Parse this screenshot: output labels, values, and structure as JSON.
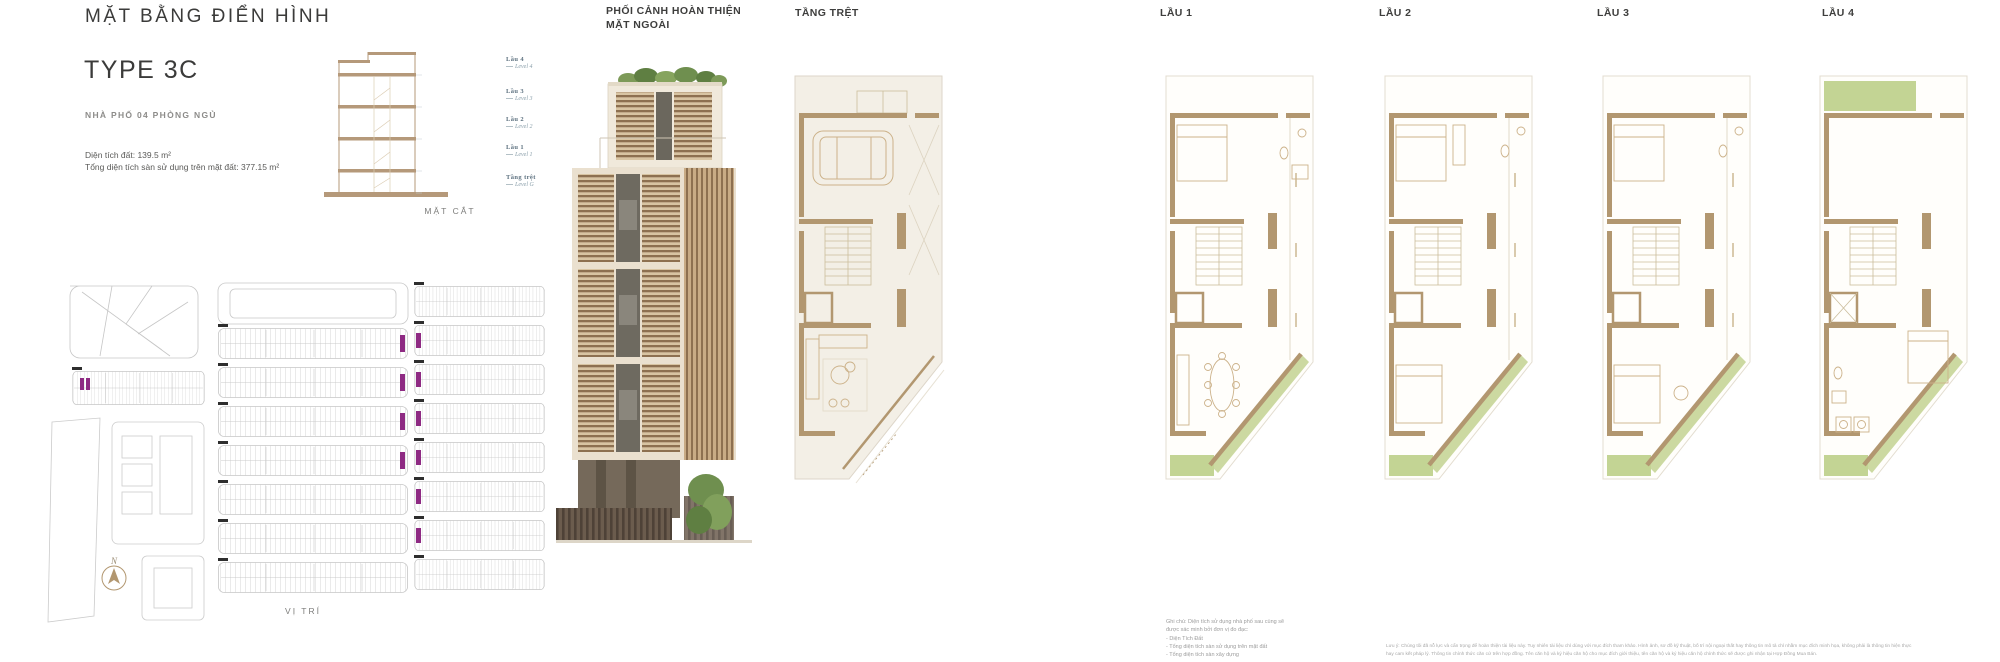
{
  "header": {
    "title": "MẶT BẰNG ĐIỂN HÌNH",
    "type": "TYPE 3C",
    "subtitle": "NHÀ PHỐ 04 PHÒNG NGỦ",
    "area_land": "Diện tích đất: 139.5 m²",
    "area_floor": "Tổng diện tích sàn sử dụng trên mặt đất: 377.15 m²"
  },
  "section_figure": {
    "caption": "MẶT CẮT",
    "levels": [
      {
        "vi": "Lầu 4",
        "en": "Level 4"
      },
      {
        "vi": "Lầu 3",
        "en": "Level 3"
      },
      {
        "vi": "Lầu 2",
        "en": "Level 2"
      },
      {
        "vi": "Lầu 1",
        "en": "Level 1"
      },
      {
        "vi": "Tầng trệt",
        "en": "Level G"
      }
    ]
  },
  "site_figure": {
    "caption": "VỊ TRÍ",
    "compass": "N"
  },
  "render_figure": {
    "caption": "PHỐI CẢNH HOÀN THIỆN\nMẶT NGOÀI"
  },
  "plans": [
    {
      "label": "TẦNG TRỆT"
    },
    {
      "label": "LẦU 1"
    },
    {
      "label": "LẦU 2"
    },
    {
      "label": "LẦU 3"
    },
    {
      "label": "LẦU 4"
    }
  ],
  "notes": {
    "ghi_chu_intro": "Ghi chú: Diện tích sử dụng nhà phố sau cùng sẽ\nđược xác minh bởi đơn vị đo đạc:",
    "ghi_chu_items": [
      "- Diện Tích Đất",
      "- Tổng diện tích sàn sử dụng trên mặt đất",
      "- Tổng diện tích sàn xây dựng"
    ],
    "disclaimer": "Lưu ý: Chúng tôi đã nỗ lực và cẩn trọng để hoàn thiện tài liệu này. Tuy nhiên tài liệu chỉ dùng với mục đích tham khảo. Hình ảnh, sơ đồ kỹ thuật, bố trí nội ngoại thất hay thông tin mô tả chỉ nhằm mục đích minh họa, không phải là thông tin hiện thực hay cam kết pháp lý. Thông tin chính thức căn cứ trên hợp đồng. Tên căn hộ và ký hiệu căn hộ cho mục đích giới thiệu, tên căn hộ và ký hiệu căn hộ chính thức sẽ được ghi nhận tại Hợp Đồng Mua Bán."
  },
  "palette": {
    "wall_tan": "#b29770",
    "section_tan": "#b5997a",
    "beige_floor": "#f3efe6",
    "balcony_green": "#c3d494",
    "highlight_purple": "#8e2a83",
    "label_slate": "#5e7280",
    "text_dark": "#3b3b3a",
    "text_gray": "#9c9c9c"
  }
}
